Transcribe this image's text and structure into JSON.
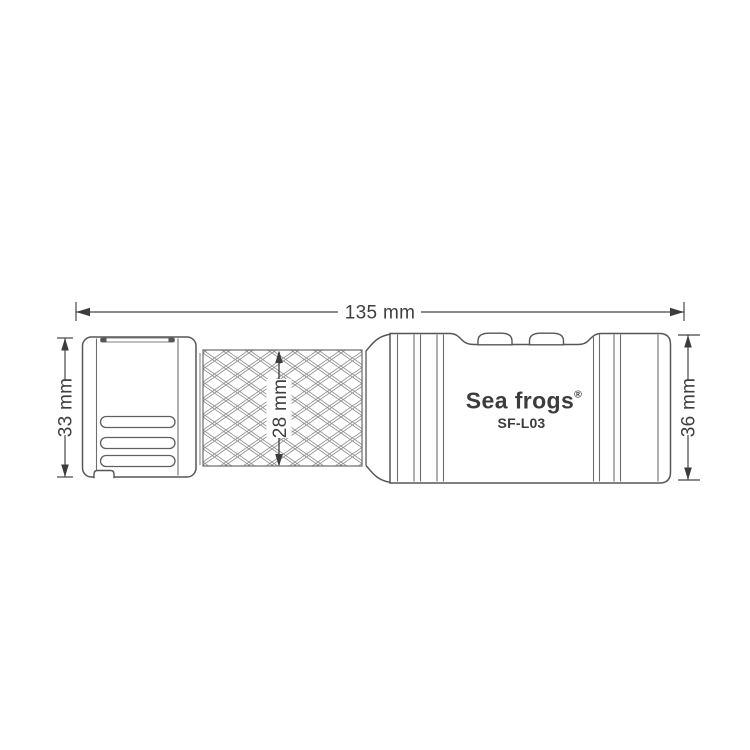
{
  "page": {
    "background_color": "#ffffff",
    "kind": "product dimension drawing"
  },
  "product": {
    "brand": "Sea frogs",
    "registered_mark": "®",
    "model": "SF-L03"
  },
  "dimensions": {
    "unit": "mm",
    "length": {
      "label": "135 mm",
      "value": 135
    },
    "head_diameter": {
      "label": "33 mm",
      "value": 33
    },
    "grip_diameter": {
      "label": "28 mm",
      "value": 28
    },
    "body_diameter": {
      "label": "36 mm",
      "value": 36
    }
  },
  "colors": {
    "outline": "#565656",
    "detail_line": "#6e6e6e",
    "dimension_line": "#454545",
    "text": "#3c3c3c",
    "knurl_line": "#8d8d8d",
    "background": "#ffffff"
  }
}
